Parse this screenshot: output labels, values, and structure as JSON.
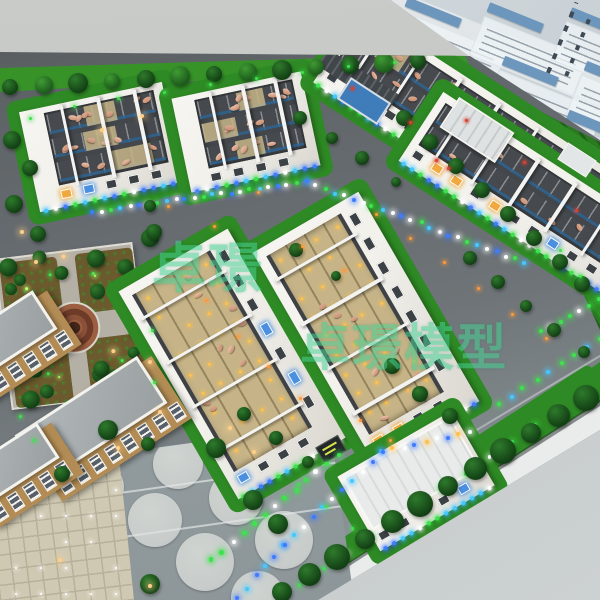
{
  "image": {
    "kind": "photograph",
    "subject": "Architectural scale model of a pig-farm industrial park on a display table, with a tilted information board behind it",
    "width": 600,
    "height": 600
  },
  "watermark": {
    "small_text": "卓璟",
    "large_text": "卓璟模型",
    "color_hex": "#45cf92",
    "opacity": 0.55
  },
  "display_board": {
    "description": "light board with blue title bars, pale text panels and a vertical calligraphy column; text too small to read",
    "title_bar_count": 8,
    "panel_count": 8,
    "calligraphy_columns": 2
  },
  "model": {
    "buildings": {
      "open_roof_pig_barns": 4,
      "long_finishing_barns": 2,
      "office_buildings": 3,
      "field_sheds": 2,
      "roofed_warehouse": 1
    },
    "features": [
      "circular landscaped park",
      "seven circular tank pads",
      "tiled plaza with ground lights",
      "crop field plots",
      "perimeter hedge rows",
      "LED-lit roads",
      "pig pens with model pigs",
      "white roof trusses",
      "blue water pool"
    ],
    "palette": {
      "wall": "#c6c8c5",
      "floor": "#c0c6c6",
      "board": "#ccd3d7",
      "board_bar": "#6d96bd",
      "board_panel": "#eef3f6",
      "board_text": "#7a8792",
      "board_ink": "#3e4a55",
      "road": "#64696d",
      "road_dark": "#54585c",
      "pad": "#929b9e",
      "pad_circle": "#c7ccca",
      "base_edge": "#e9eceb",
      "plaza": "#cfc9b3",
      "plaza_line": "#b7b09a",
      "grass": "#379328",
      "grass_dark": "#256e1e",
      "hedge": "#2e8a24",
      "bush": "#1b5418",
      "field": "#2a7a20",
      "park_path": "#b5b0a6",
      "park_bed": "#6b5a2d",
      "park_ring": "#9c5f41",
      "park_ring_dark": "#6e3b28",
      "barn_wall": "#f2f1ec",
      "barn_wall_shade": "#dbd7d0",
      "barn_interior": "#43474b",
      "pen_floor": "#c6b488",
      "truss": "#f3f3f1",
      "pig": "#dcab92",
      "pig_light": "#ecc3ac",
      "water": "#2f6390",
      "pool": "#3f7cba",
      "window_dark": "#3c4145",
      "window_blue": "#4a8fe0",
      "window_warm": "#f0a93f",
      "office_wall": "#b28c54",
      "office_roof": "#9aa0a2",
      "led_green": "#3ee24e",
      "led_blue": "#3d7bff",
      "led_cyan": "#45c8ff",
      "led_white": "#ffffff",
      "lamp_warm": "#ffcf8a",
      "accent_orange": "#ff9a3c",
      "flower_red": "#d84334",
      "amber": "#ffc14d"
    }
  }
}
